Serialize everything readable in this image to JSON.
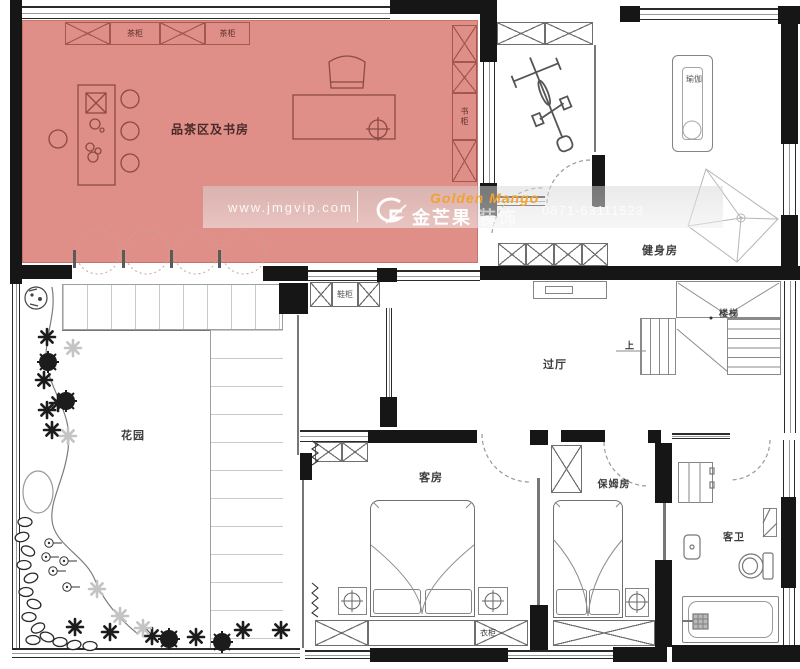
{
  "colors": {
    "highlight": "#df8e88",
    "accent": "#f0a232"
  },
  "watermark": {
    "url": "www.jmgvip.com",
    "brand_en": "Golden Mango",
    "brand_cn": "金芒果",
    "brand_suffix": "装饰",
    "phone": "0871-63111523",
    "logo_letter": "G"
  },
  "rooms": {
    "tea_study": {
      "label": "品茶区及书房"
    },
    "gym": {
      "label": "健身房"
    },
    "yoga": {
      "label": "瑜伽"
    },
    "hallway": {
      "label": "过厅"
    },
    "stairs": {
      "label": "楼梯",
      "up": "上"
    },
    "garden": {
      "label": "花园"
    },
    "guest_room": {
      "label": "客房"
    },
    "nanny_room": {
      "label": "保姆房"
    },
    "guest_bath": {
      "label": "客卫"
    }
  },
  "cabinets": {
    "tea_cabinet_1": "茶柜",
    "tea_cabinet_2": "茶柜",
    "book_cabinet": "书柜",
    "shoe_cabinet": "鞋柜",
    "wardrobe": "衣柜"
  }
}
